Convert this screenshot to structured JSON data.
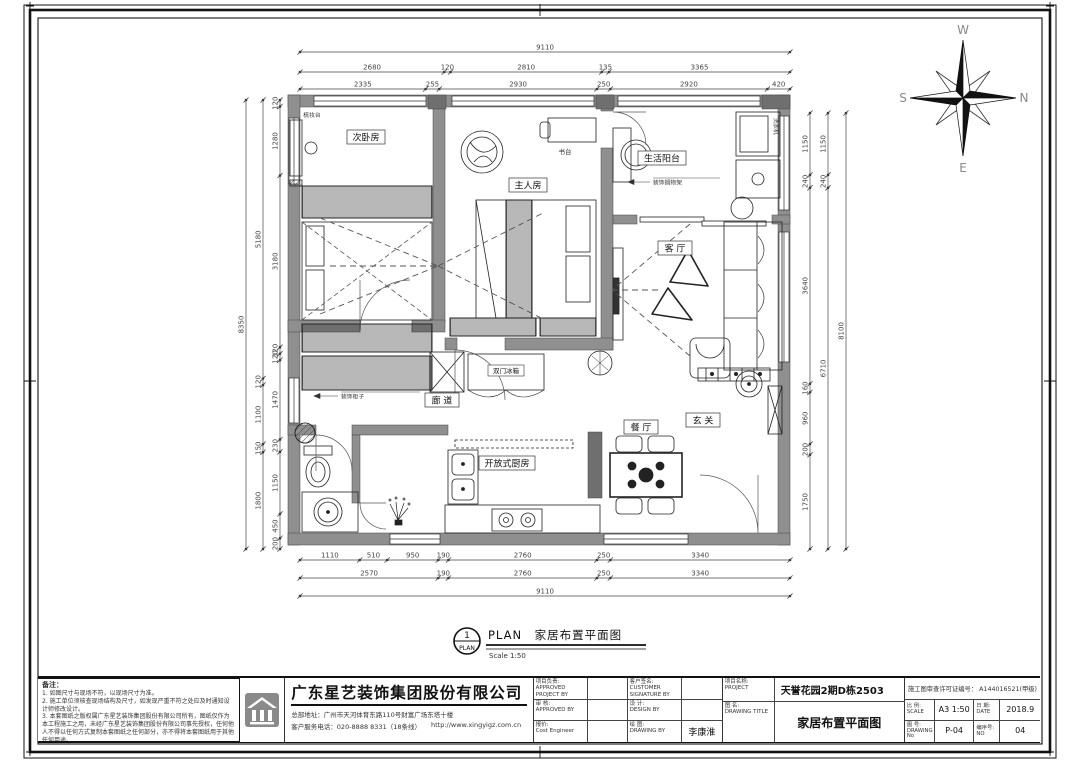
{
  "compass": {
    "top": "W",
    "right": "N",
    "bottom": "E",
    "left": "S"
  },
  "plan_title": {
    "num": "1",
    "tag": "PLAN",
    "text": "PLAN　家居布置平面图",
    "scale": "Scale 1:50"
  },
  "rooms": {
    "secondary_bedroom": "次卧房",
    "master_bedroom": "主人房",
    "living_balcony": "生活阳台",
    "living_room": "客 厅",
    "foyer": "玄 关",
    "dining_room": "餐 厅",
    "corridor": "廊 道",
    "open_kitchen": "开放式厨房",
    "fridge": "双门冰箱",
    "desk": "书台",
    "dressing_table": "梳妆台",
    "washer": "洗衣机"
  },
  "annotations": {
    "cabinet": "装饰柜子",
    "shelf": "装饰搁物架"
  },
  "dimensions": {
    "top": [
      [
        "9110"
      ],
      [
        "2680",
        "120",
        "2810",
        "135",
        "3365"
      ],
      [
        "2335",
        "255",
        "2930",
        "250",
        "2920",
        "420"
      ]
    ],
    "bottom": [
      [
        "1110",
        "510",
        "950",
        "190",
        "2760",
        "250",
        "3340"
      ],
      [
        "2570",
        "190",
        "2760",
        "250",
        "3340"
      ],
      [
        "9110"
      ]
    ],
    "left": [
      [
        "8350"
      ],
      [
        "5180",
        "120",
        "1100",
        "150",
        "1800"
      ],
      [
        "120",
        "1280",
        "3180",
        "120",
        "120",
        "1470",
        "230",
        "1150",
        "450",
        "200"
      ]
    ],
    "right": [
      [
        "1150",
        "240",
        "3640",
        "160",
        "960",
        "200",
        "1750"
      ],
      [
        "1150",
        "240",
        "6710"
      ],
      [
        "8100"
      ]
    ]
  },
  "notes": {
    "title": "备注：",
    "items": [
      "1. 如图尺寸与现场不符，以现场尺寸为准。",
      "2. 施工单位须核查现场结构及尺寸，如发现严重不符之处应及时通知设计师修改设计。",
      "3. 本套图纸之版权属广东星艺装饰集团股份有限公司所有，图纸仅作为本工程施工之用，未经广东星艺装饰集团股份有限公司事先授权，任何他人不得以任何方式复制本套图纸之任何部分，亦不得将本套图纸用于其他任何用途。"
    ]
  },
  "titleblock": {
    "company": {
      "name": "广东星艺装饰集团股份有限公司",
      "address": "总部地址：广州市天河体育东路110号财富广场东塔十楼",
      "phone": "客户服务电话：020-8888 8331（18条线）",
      "url": "http://www.xingyigz.com.cn"
    },
    "cells": {
      "project_lead": {
        "zh": "项目负责:",
        "en": "APPROVED PROJECT BY"
      },
      "customer": {
        "zh": "客户签名:",
        "en": "CUSTOMER SIGNATURE BY"
      },
      "review": {
        "zh": "审 核:",
        "en": "APPROVED BY"
      },
      "design": {
        "zh": "设 计:",
        "en": "DESIGN BY"
      },
      "quote": {
        "zh": "报价:",
        "en": "Cost Engineer"
      },
      "draw": {
        "zh": "绘 图:",
        "en": "DRAWING BY",
        "value": "李康淮"
      },
      "project_name": {
        "zh": "项目名称:",
        "en": "PROJECT",
        "value": "天誉花园2期D栋2503"
      },
      "drawing_title": {
        "zh": "图 名:",
        "en": "DRAWING TITLE",
        "value": "家居布置平面图"
      },
      "permit": "施工图审查许可证编号： A144016521(甲级)",
      "scale": {
        "zh": "比 例:",
        "en": "SCALE",
        "value": "A3 1:50"
      },
      "date": {
        "zh": "日 期:",
        "en": "DATE",
        "value": "2018.9"
      },
      "drawing_no": {
        "zh": "图 号:",
        "en": "DRAWING No",
        "value": "P-04"
      },
      "serial": {
        "zh": "编序号:",
        "en": "NO",
        "value": "04"
      }
    }
  }
}
